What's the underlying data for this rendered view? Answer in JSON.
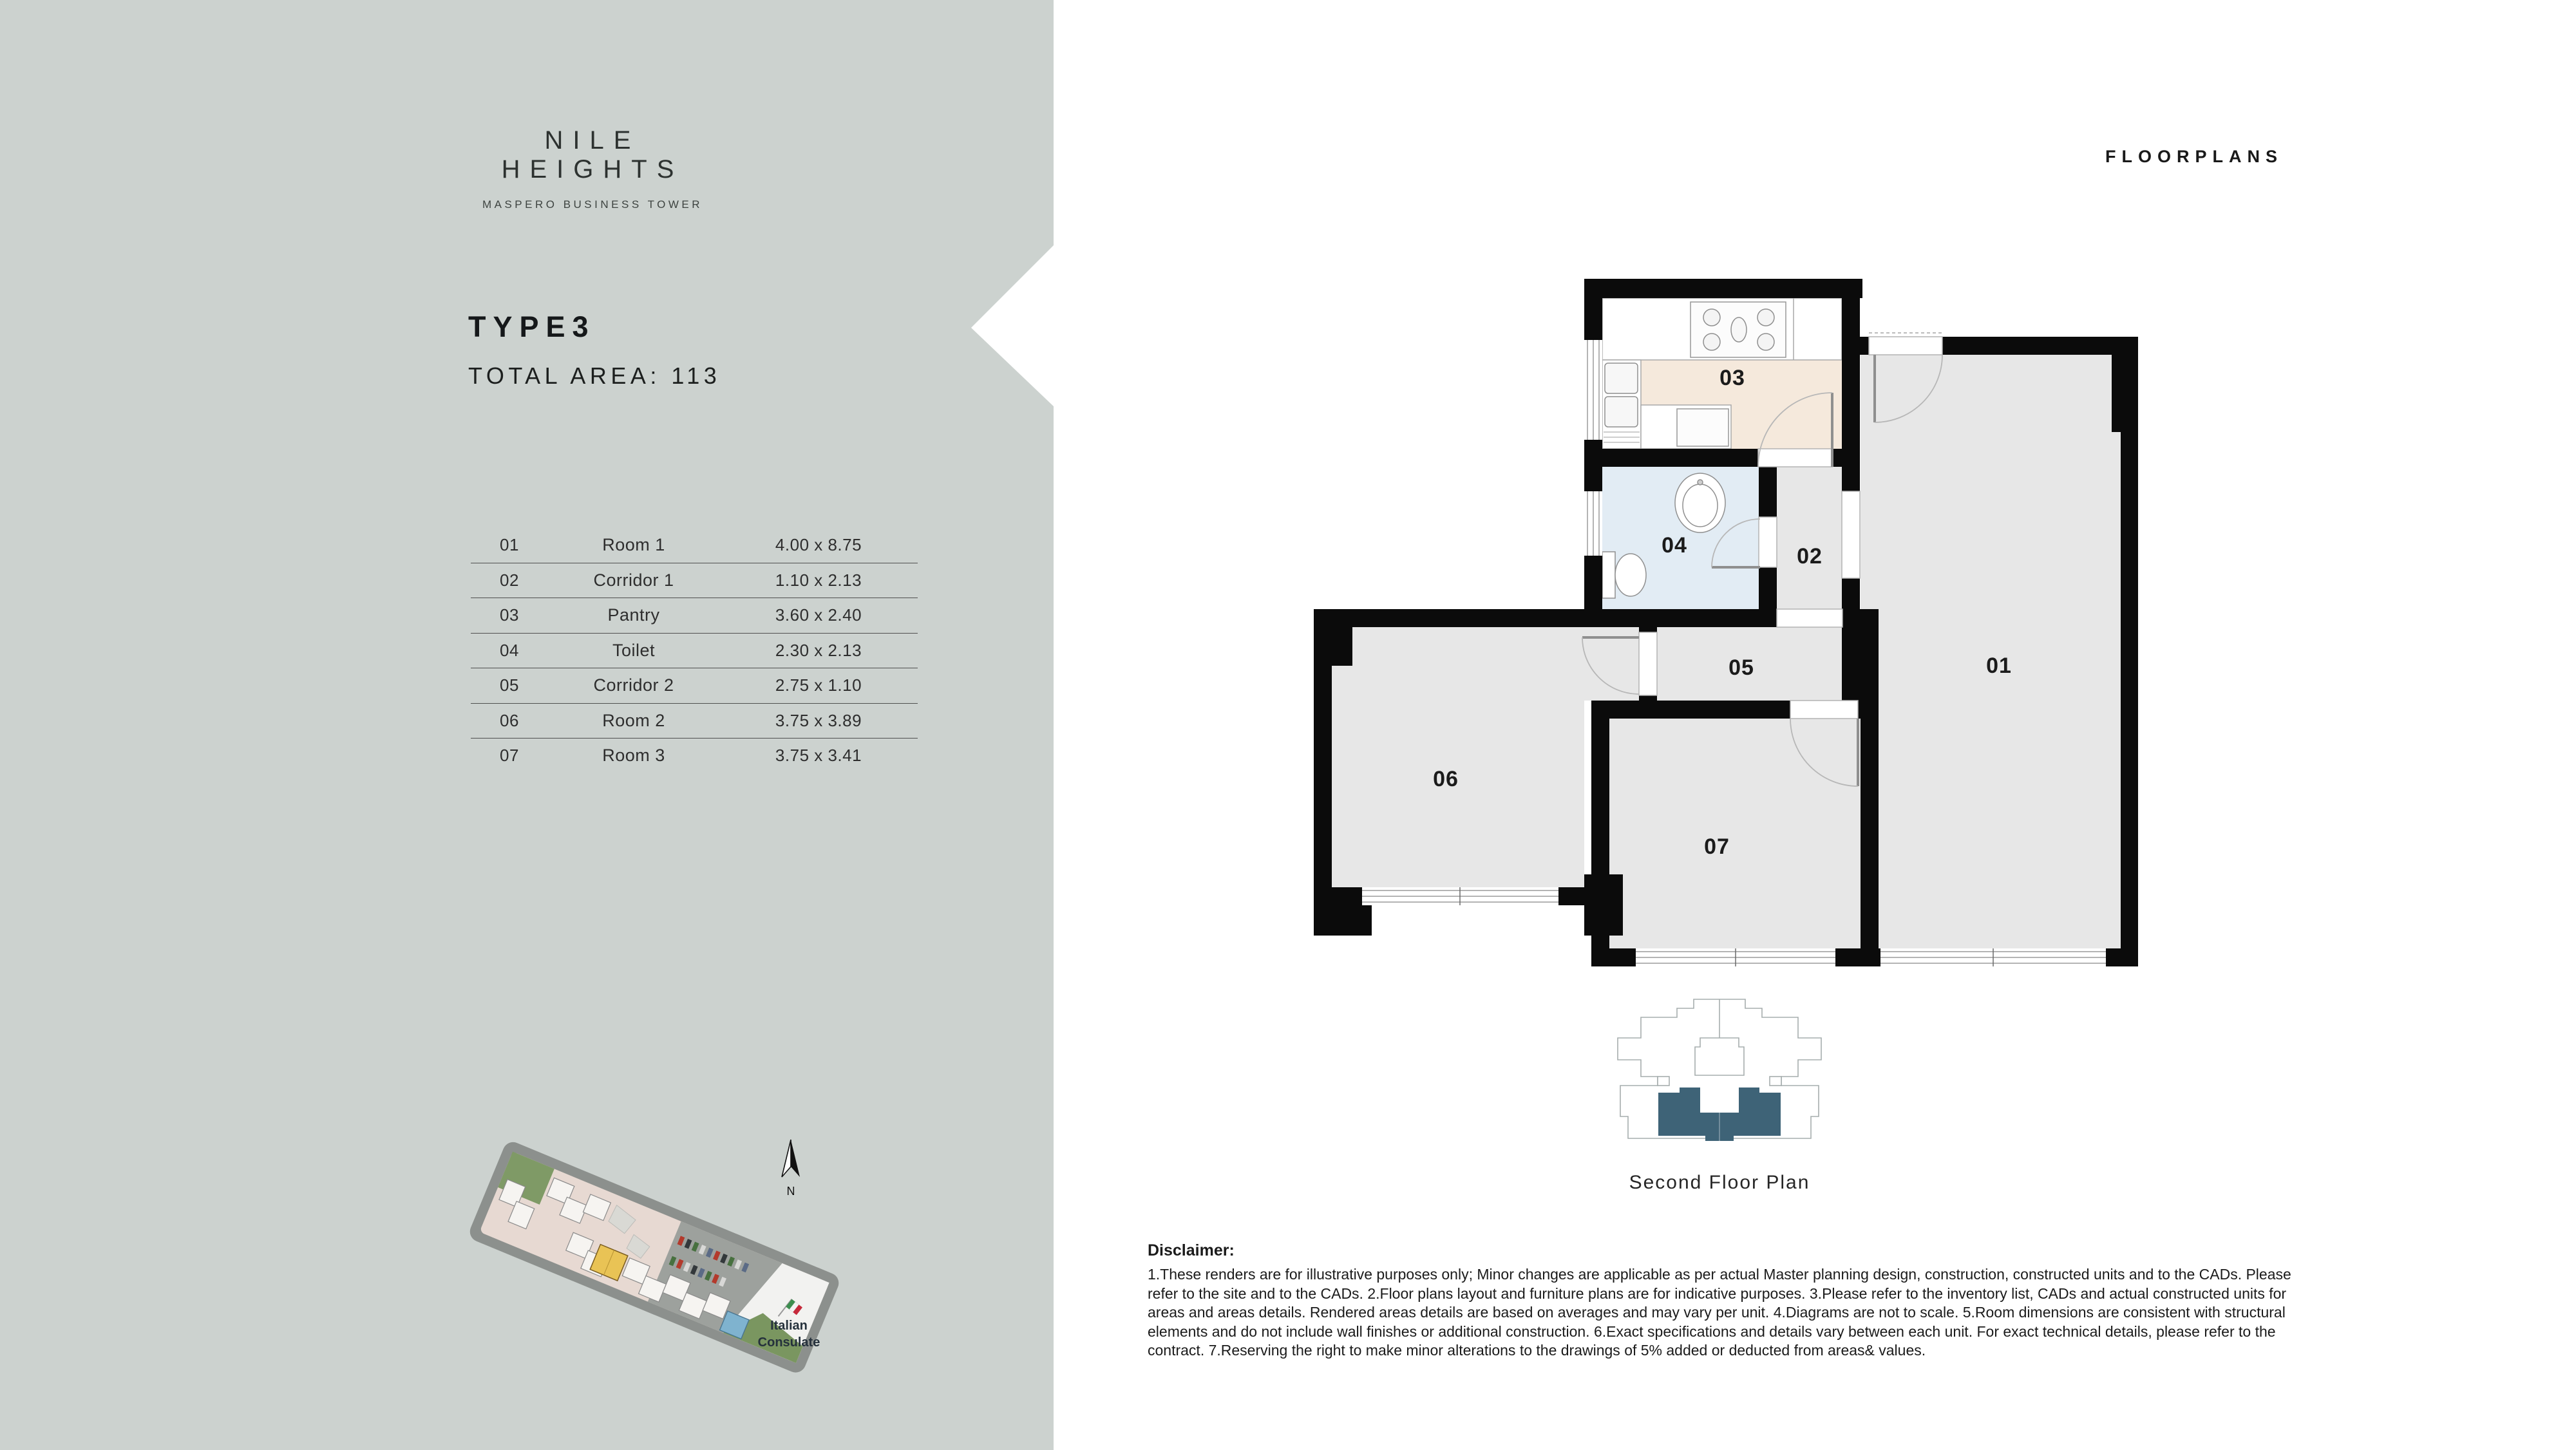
{
  "brand": {
    "name": "NILE HEIGHTS",
    "subtitle": "MASPERO BUSINESS TOWER"
  },
  "page": {
    "label": "FLOORPLANS"
  },
  "unit": {
    "type": "TYPE3",
    "total_area": "TOTAL AREA: 113"
  },
  "rooms": [
    {
      "no": "01",
      "name": "Room 1",
      "dims": "4.00 x 8.75"
    },
    {
      "no": "02",
      "name": "Corridor 1",
      "dims": "1.10 x 2.13"
    },
    {
      "no": "03",
      "name": "Pantry",
      "dims": "3.60 x 2.40"
    },
    {
      "no": "04",
      "name": "Toilet",
      "dims": "2.30 x 2.13"
    },
    {
      "no": "05",
      "name": "Corridor 2",
      "dims": "2.75 x 1.10"
    },
    {
      "no": "06",
      "name": "Room 2",
      "dims": "3.75 x 3.89"
    },
    {
      "no": "07",
      "name": "Room 3",
      "dims": "3.75 x 3.41"
    }
  ],
  "floorplan": {
    "labels": {
      "r01": "01",
      "r02": "02",
      "r03": "03",
      "r04": "04",
      "r05": "05",
      "r06": "06",
      "r07": "07"
    }
  },
  "keyplan": {
    "caption": "Second Floor Plan"
  },
  "siteplan": {
    "consulate_line1": "Italian",
    "consulate_line2": "Consulate",
    "north": "N"
  },
  "disclaimer": {
    "heading": "Disclaimer:",
    "body": "1.These renders are for illustrative purposes only; Minor changes are applicable as per actual Master planning design, construction, constructed units and to the CADs. Please refer to the site and to the CADs. 2.Floor plans layout and furniture plans are for indicative purposes. 3.Please refer to the inventory list, CADs and actual constructed units for areas and areas details. Rendered areas details are based on averages and may vary per unit. 4.Diagrams are not to scale. 5.Room dimensions are consistent with structural elements and do not include wall finishes or additional construction. 6.Exact specifications and details vary between each unit. For exact technical details, please refer to the contract. 7.Reserving the right to make minor alterations to the drawings of 5% added or deducted from areas& values."
  },
  "colors": {
    "panel": "#ccd2cf",
    "wall": "#0b0b0b",
    "room_gray": "#e7e7e7",
    "pantry_beige": "#f5e9dc",
    "toilet_blue": "#e2ecf4",
    "keyplan_teal": "#3e6377",
    "highlight_yellow": "#e9c355"
  }
}
